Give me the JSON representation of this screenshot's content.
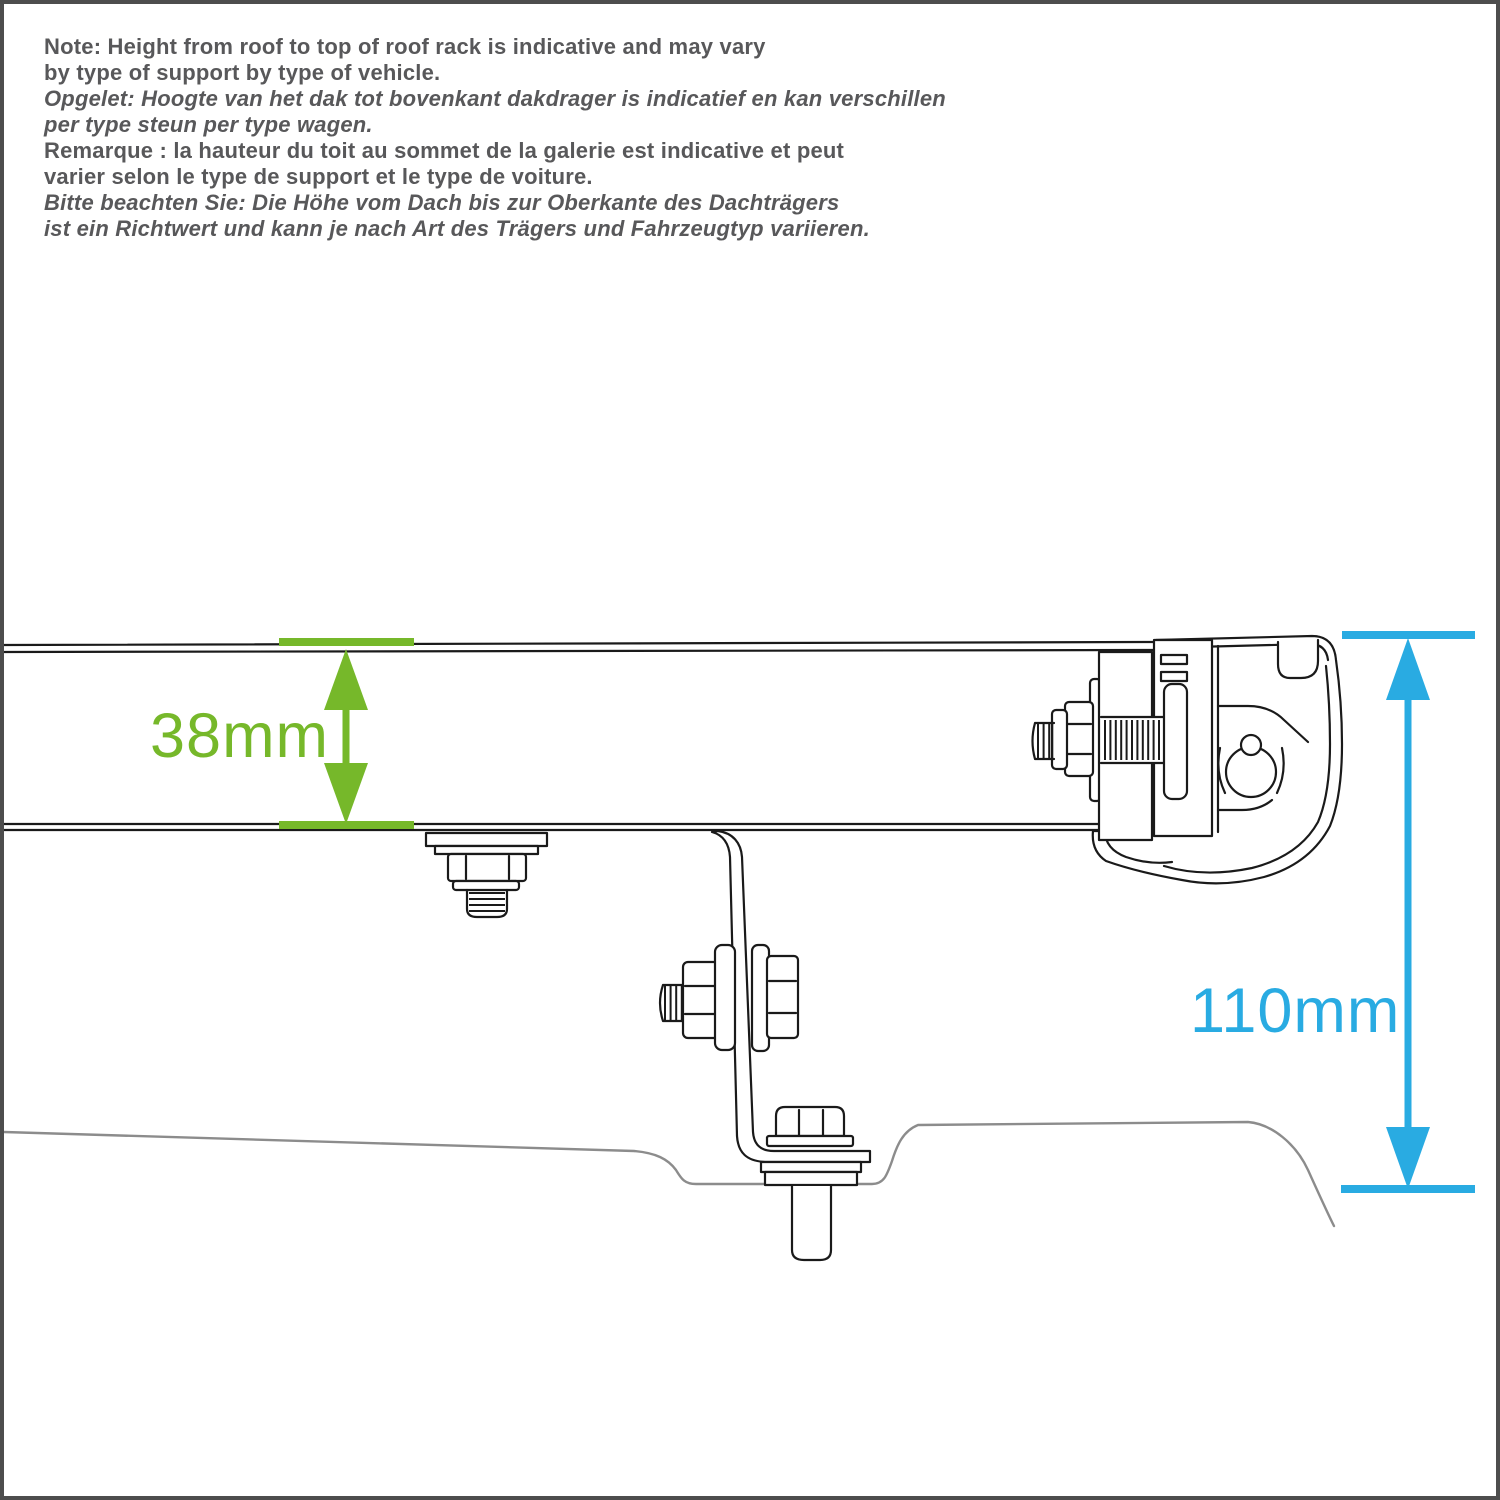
{
  "page": {
    "background": "#ffffff",
    "frame_color": "#4d4d4d"
  },
  "note": {
    "text_color": "#58585a",
    "lines": [
      {
        "lang": "en",
        "style": "bold",
        "text": "Note: Height from roof to top of roof rack is indicative and may vary"
      },
      {
        "lang": "en",
        "style": "bold",
        "text": "by type of support by type of vehicle."
      },
      {
        "lang": "nl",
        "style": "bold-italic",
        "text": "Opgelet: Hoogte van het dak tot bovenkant dakdrager is indicatief en kan verschillen"
      },
      {
        "lang": "nl",
        "style": "bold-italic",
        "text": "per type steun per type wagen."
      },
      {
        "lang": "fr",
        "style": "bold",
        "text": "Remarque : la hauteur du toit au sommet de la galerie est indicative et peut"
      },
      {
        "lang": "fr",
        "style": "bold",
        "text": "varier selon le type de support et le type de voiture."
      },
      {
        "lang": "de",
        "style": "bold-italic",
        "text": "Bitte beachten Sie: Die Höhe vom Dach bis zur Oberkante des Dachträgers"
      },
      {
        "lang": "de",
        "style": "bold-italic",
        "text": "ist ein Richtwert und kann je nach Art des Trägers und Fahrzeugtyp variieren."
      }
    ]
  },
  "dimensions": {
    "rack_height": {
      "label": "38mm",
      "color": "#76b82a"
    },
    "roof_to_top": {
      "label": "110mm",
      "color": "#29abe2"
    }
  },
  "drawing": {
    "ink_color": "#1a1a1a",
    "roof_line_color": "#8c8c8c"
  }
}
